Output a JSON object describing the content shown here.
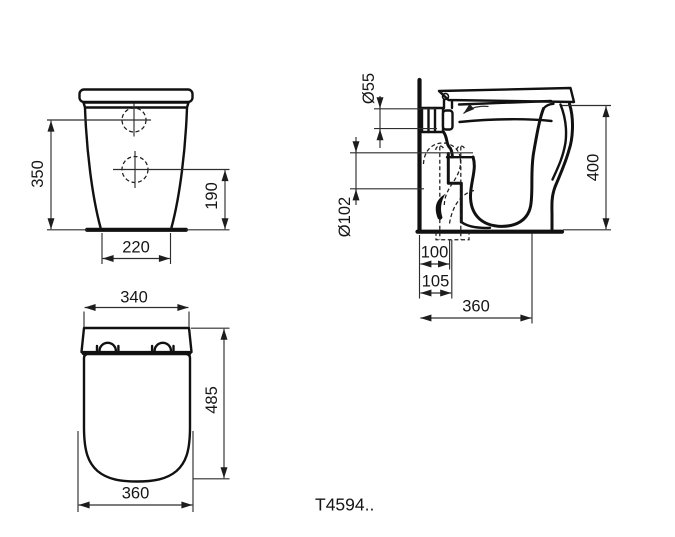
{
  "product": {
    "code": "T4594.."
  },
  "views": {
    "front": {
      "dim_height_total": "350",
      "dim_hole_height": "190",
      "dim_base_width": "220"
    },
    "side": {
      "dim_inlet_diameter": "Ø55",
      "dim_outlet_diameter": "Ø102",
      "dim_height": "400",
      "dim_outlet_center": "100",
      "dim_outlet_edge": "105",
      "dim_depth": "360"
    },
    "seat": {
      "dim_width_top": "340",
      "dim_length": "485",
      "dim_width_bottom": "360"
    }
  },
  "colors": {
    "line": "#111111",
    "dimension_line": "#2e2e2e",
    "background": "#ffffff"
  }
}
